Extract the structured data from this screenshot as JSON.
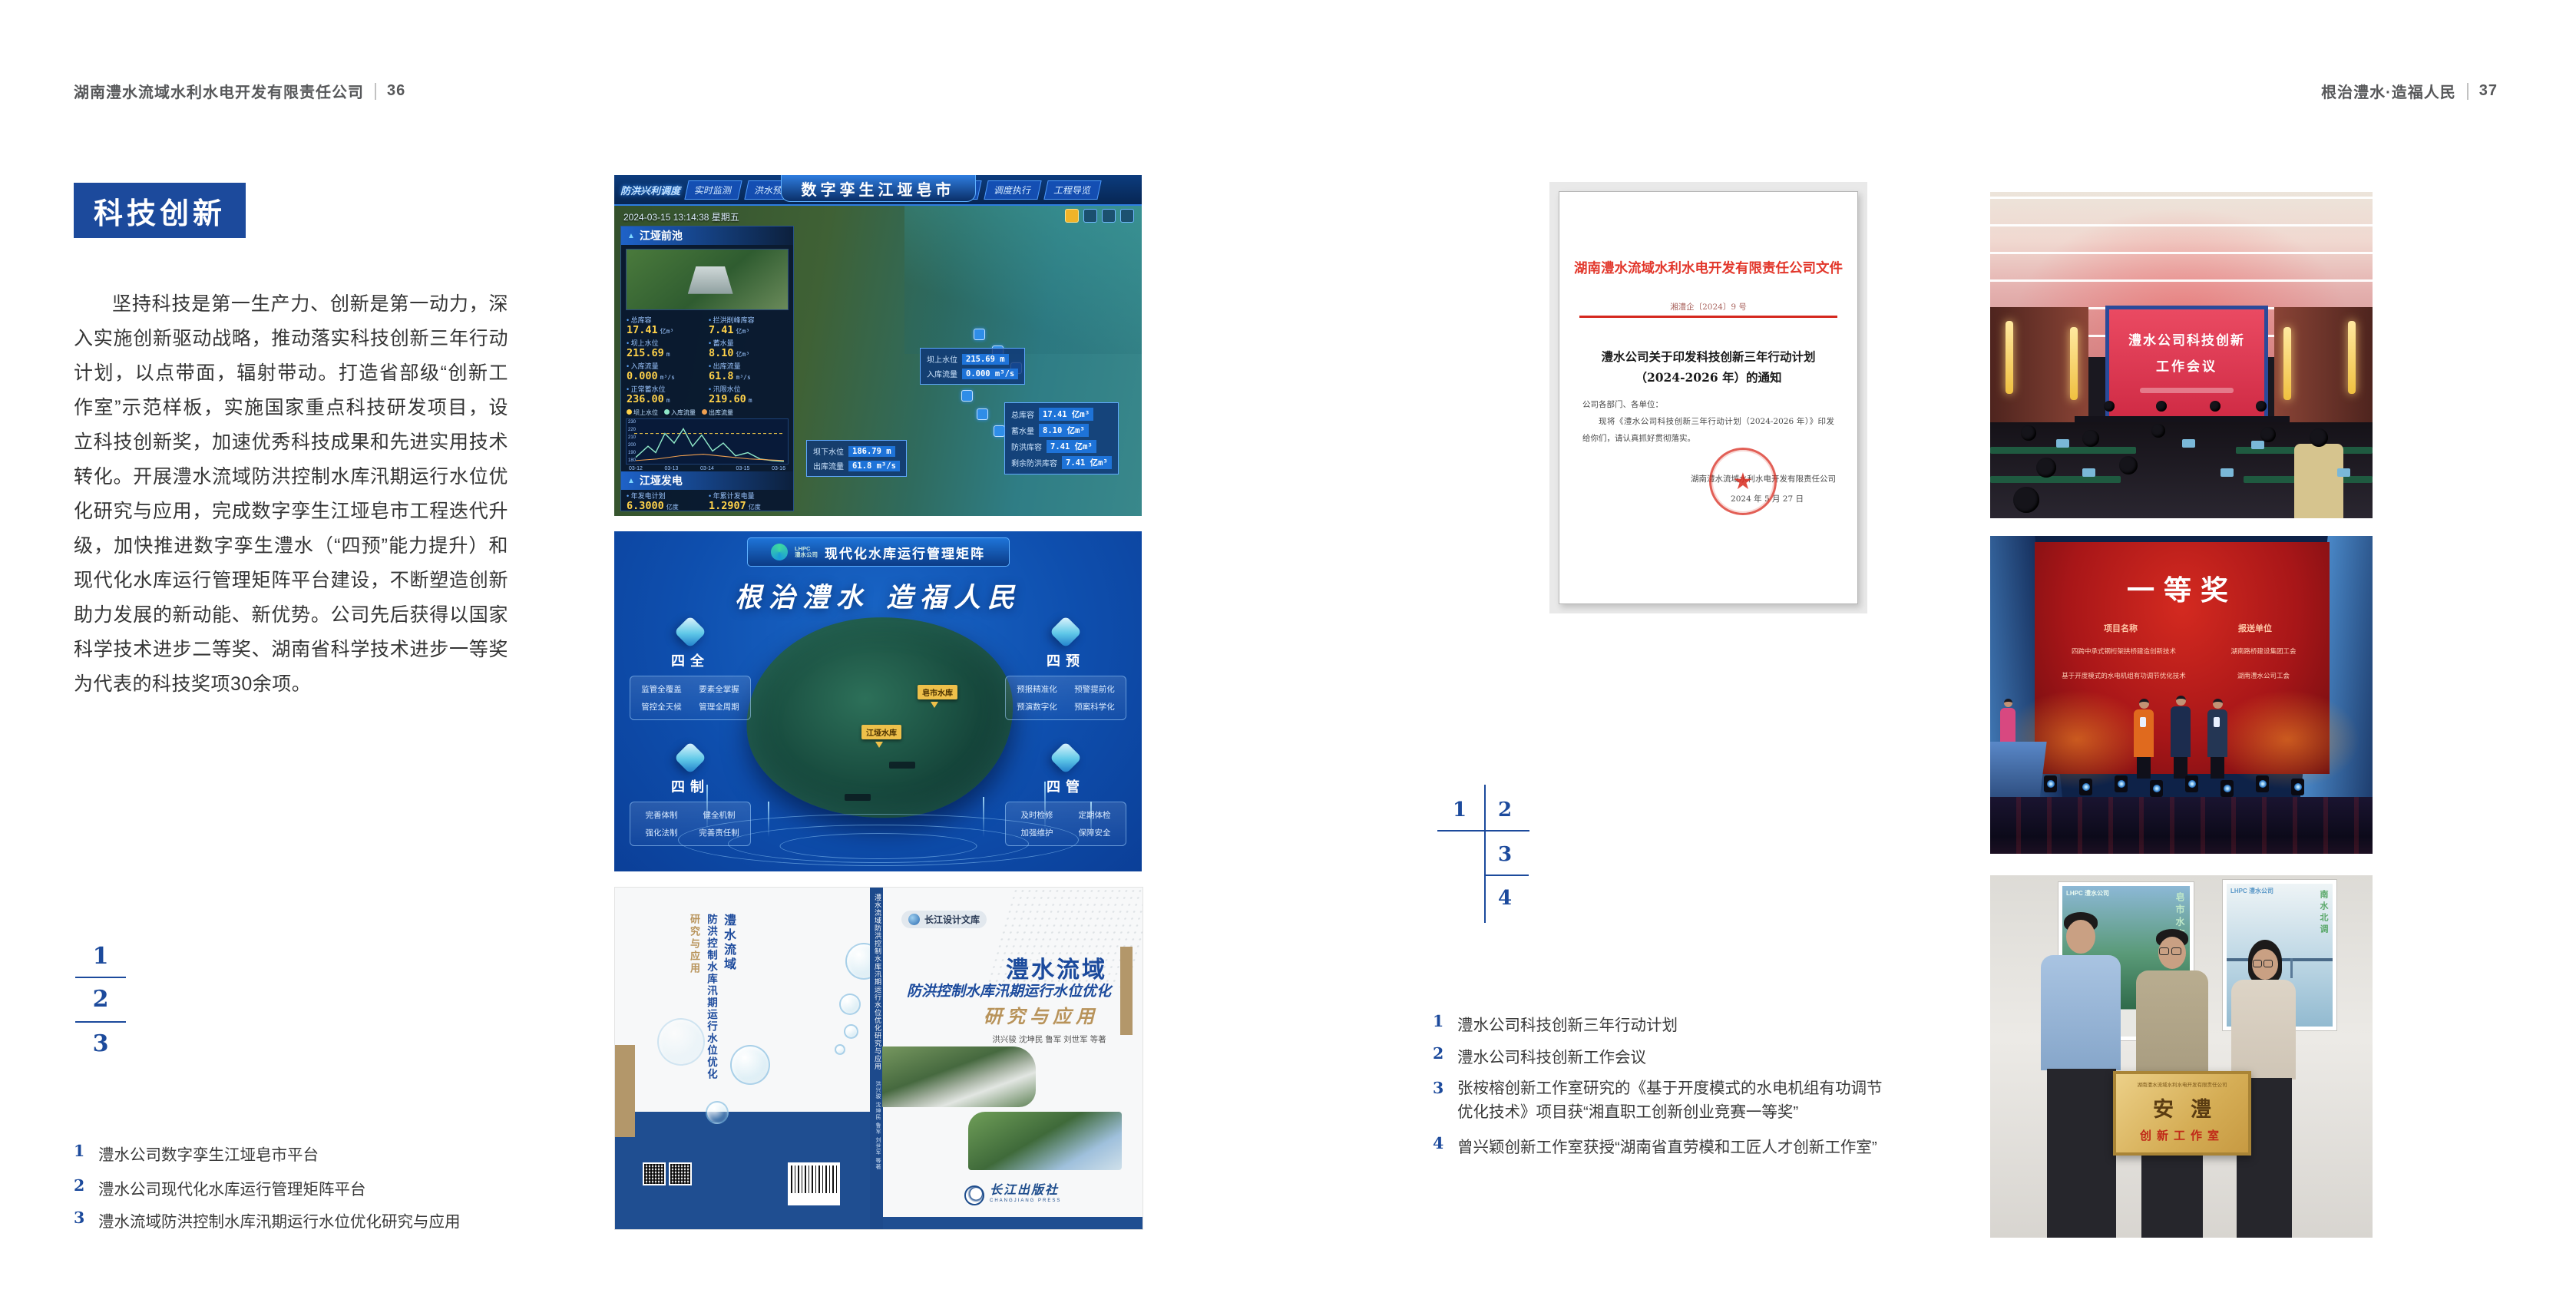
{
  "header": {
    "left_company": "湖南澧水流域水利水电开发有限责任公司",
    "left_page_no": "36",
    "right_slogan": "根治澧水·造福人民",
    "right_page_no": "37"
  },
  "left_page": {
    "section_title": "科技创新",
    "paragraph": "坚持科技是第一生产力、创新是第一动力，深入实施创新驱动战略，推动落实科技创新三年行动计划，以点带面，辐射带动。打造省部级“创新工作室”示范样板，实施国家重点科技研发项目，设立科技创新奖，加速优秀科技成果和先进实用技术转化。开展澧水流域防洪控制水库汛期运行水位优化研究与应用，完成数字孪生江垭皂市工程迭代升级，加快推进数字孪生澧水（“四预”能力提升）和现代化水库运行管理矩阵平台建设，不断塑造创新助力发展的新动能、新优势。公司先后获得以国家科学技术进步二等奖、湖南省科学技术进步一等奖为代表的科技奖项30余项。",
    "index": {
      "n1": "1",
      "n2": "2",
      "n3": "3"
    },
    "captions": [
      {
        "no": "1",
        "text": "澧水公司数字孪生江垭皂市平台"
      },
      {
        "no": "2",
        "text": "澧水公司现代化水库运行管理矩阵平台"
      },
      {
        "no": "3",
        "text": "澧水流域防洪控制水库汛期运行水位优化研究与应用"
      }
    ]
  },
  "fig_twin": {
    "corner_label": "防洪兴利调度",
    "title": "数字孪生江垭皂市",
    "tabs_left": [
      "实时监测",
      "洪水预报",
      "防汛预警"
    ],
    "tabs_right": [
      "风险预判",
      "预案生成",
      "调度执行",
      "工程导览"
    ],
    "timestamp": "2024-03-15 13:14:38 星期五",
    "panel_title": "江垭前池",
    "stats": [
      {
        "label": "总库容",
        "value": "17.41",
        "unit": "亿m³"
      },
      {
        "label": "拦洪削峰库容",
        "value": "7.41",
        "unit": "亿m³"
      },
      {
        "label": "坝上水位",
        "value": "215.69",
        "unit": "m"
      },
      {
        "label": "蓄水量",
        "value": "8.10",
        "unit": "亿m³"
      },
      {
        "label": "入库流量",
        "value": "0.000",
        "unit": "m³/s"
      },
      {
        "label": "出库流量",
        "value": "61.8",
        "unit": "m³/s"
      },
      {
        "label": "正常蓄水位",
        "value": "236.00",
        "unit": "m"
      },
      {
        "label": "汛限水位",
        "value": "219.60",
        "unit": "m"
      }
    ],
    "legend": [
      "坝上水位",
      "入库流量",
      "出库流量"
    ],
    "chart_y": [
      "230",
      "220",
      "210",
      "200",
      "190",
      "180"
    ],
    "chart_x": [
      "03-12",
      "03-13",
      "03-14",
      "03-15",
      "03-16"
    ],
    "power_title": "江垭发电",
    "power_stats": [
      {
        "label": "年发电计划",
        "value": "6.3000",
        "unit": "亿度"
      },
      {
        "label": "年累计发电量",
        "value": "1.2907",
        "unit": "亿度"
      },
      {
        "label": "月累计发电量",
        "value": "3359.21",
        "unit": "万度"
      },
      {
        "label": "当前出力",
        "value": "0.00",
        "unit": "MW"
      },
      {
        "label": "发电流量",
        "value": "0.00",
        "unit": "m³/s"
      },
      {
        "label": "弃水流量",
        "value": "0.00",
        "unit": "m³/s"
      }
    ],
    "units": [
      "1#机组",
      "2#机组",
      "3#机组"
    ],
    "unit_values": [
      "0.00",
      "102.98",
      "0.00"
    ],
    "popup1": [
      {
        "label": "坝上水位",
        "value": "215.69 m"
      },
      {
        "label": "入库流量",
        "value": "0.000 m³/s"
      }
    ],
    "popup2": [
      {
        "label": "总库容",
        "value": "17.41 亿m³"
      },
      {
        "label": "蓄水量",
        "value": "8.10 亿m³"
      },
      {
        "label": "防洪库容",
        "value": "7.41 亿m³"
      },
      {
        "label": "剩余防洪库容",
        "value": "7.41 亿m³"
      }
    ],
    "popup3": [
      {
        "label": "坝下水位",
        "value": "186.79 m"
      },
      {
        "label": "出库流量",
        "value": "61.8 m³/s"
      }
    ]
  },
  "fig_matrix": {
    "logo_abbr": "LHPC",
    "logo_text": "澧水公司",
    "title": "现代化水库运行管理矩阵",
    "slogan": "根治澧水 造福人民",
    "panels": [
      {
        "title": "四全",
        "items": [
          "监管全覆盖",
          "要素全掌握",
          "管控全天候",
          "管理全周期"
        ]
      },
      {
        "title": "四预",
        "items": [
          "预报精准化",
          "预警提前化",
          "预演数字化",
          "预案科学化"
        ]
      },
      {
        "title": "四制",
        "items": [
          "完善体制",
          "健全机制",
          "强化法制",
          "完善责任制"
        ]
      },
      {
        "title": "四管",
        "items": [
          "及时检修",
          "定期体检",
          "加强维护",
          "保障安全"
        ]
      }
    ],
    "markers": [
      "皂市水库",
      "江垭水库"
    ]
  },
  "fig_book": {
    "series": "长江设计文库",
    "title": "澧水流域",
    "subtitle": "防洪控制水库汛期运行水位优化",
    "subtitle2": "研究与应用",
    "authors": "洪兴骏 沈坤民 鲁军 刘世军 等著",
    "publisher": "长江出版社",
    "publisher_en": "CHANGJIANG PRESS",
    "spine_title": "澧水流域防洪控制水库汛期运行水位优化研究与应用",
    "spine_authors": "洪兴骏 沈坤民 鲁军 刘世军 等著",
    "back_title1": "澧水流域",
    "back_title2": "防洪控制水库汛期运行水位优化",
    "back_title3": "研究与应用"
  },
  "right_page": {
    "document": {
      "header": "湖南澧水流域水利水电开发有限责任公司文件",
      "doc_no": "湘澧企〔2024〕9 号",
      "title_line1": "澧水公司关于印发科技创新三年行动计划",
      "title_line2": "（2024-2026 年）的通知",
      "salutation": "公司各部门、各单位：",
      "body": "现将《澧水公司科技创新三年行动计划（2024-2026 年）》印发给你们，请认真抓好贯彻落实。",
      "signer": "湖南澧水流域水利水电开发有限责任公司",
      "date": "2024 年 5 月 27 日",
      "seal_star": "★"
    },
    "index": {
      "n1": "1",
      "n2": "2",
      "n3": "3",
      "n4": "4"
    },
    "captions": [
      {
        "no": "1",
        "text": "澧水公司科技创新三年行动计划"
      },
      {
        "no": "2",
        "text": "澧水公司科技创新工作会议"
      },
      {
        "no": "3",
        "text": "张桉榕创新工作室研究的《基于开度模式的水电机组有功调节优化技术》项目获“湘直职工创新创业竞赛一等奖”"
      },
      {
        "no": "4",
        "text": "曾兴颖创新工作室获授“湖南省直劳模和工匠人才创新工作室”"
      }
    ]
  },
  "photo_meeting": {
    "screen_line1": "澧水公司科技创新",
    "screen_line2": "工作会议"
  },
  "photo_award": {
    "title": "一等奖",
    "col1": "项目名称",
    "col2": "报送单位",
    "rows": [
      {
        "project": "四跨中承式钢桁架拱桥建造创新技术",
        "unit": "湖南路桥建设集团工会"
      },
      {
        "project": "基于开度模式的水电机组有功调节优化技术",
        "unit": "湖南澧水公司工会"
      }
    ]
  },
  "photo_plaque": {
    "plaque_top": "湖南澧水流域水利水电开发有限责任公司",
    "plaque_main": "安澧",
    "plaque_sub": "创新工作室",
    "poster_left_logo": "LHPC 澧水公司",
    "poster_right_logo": "LHPC 澧水公司",
    "poster_left_text": "皂市水库",
    "poster_right_text": "南水北调"
  },
  "colors": {
    "accent_blue": "#1c4a9c",
    "doc_red": "#d5281e",
    "header_gray": "#57585a"
  }
}
